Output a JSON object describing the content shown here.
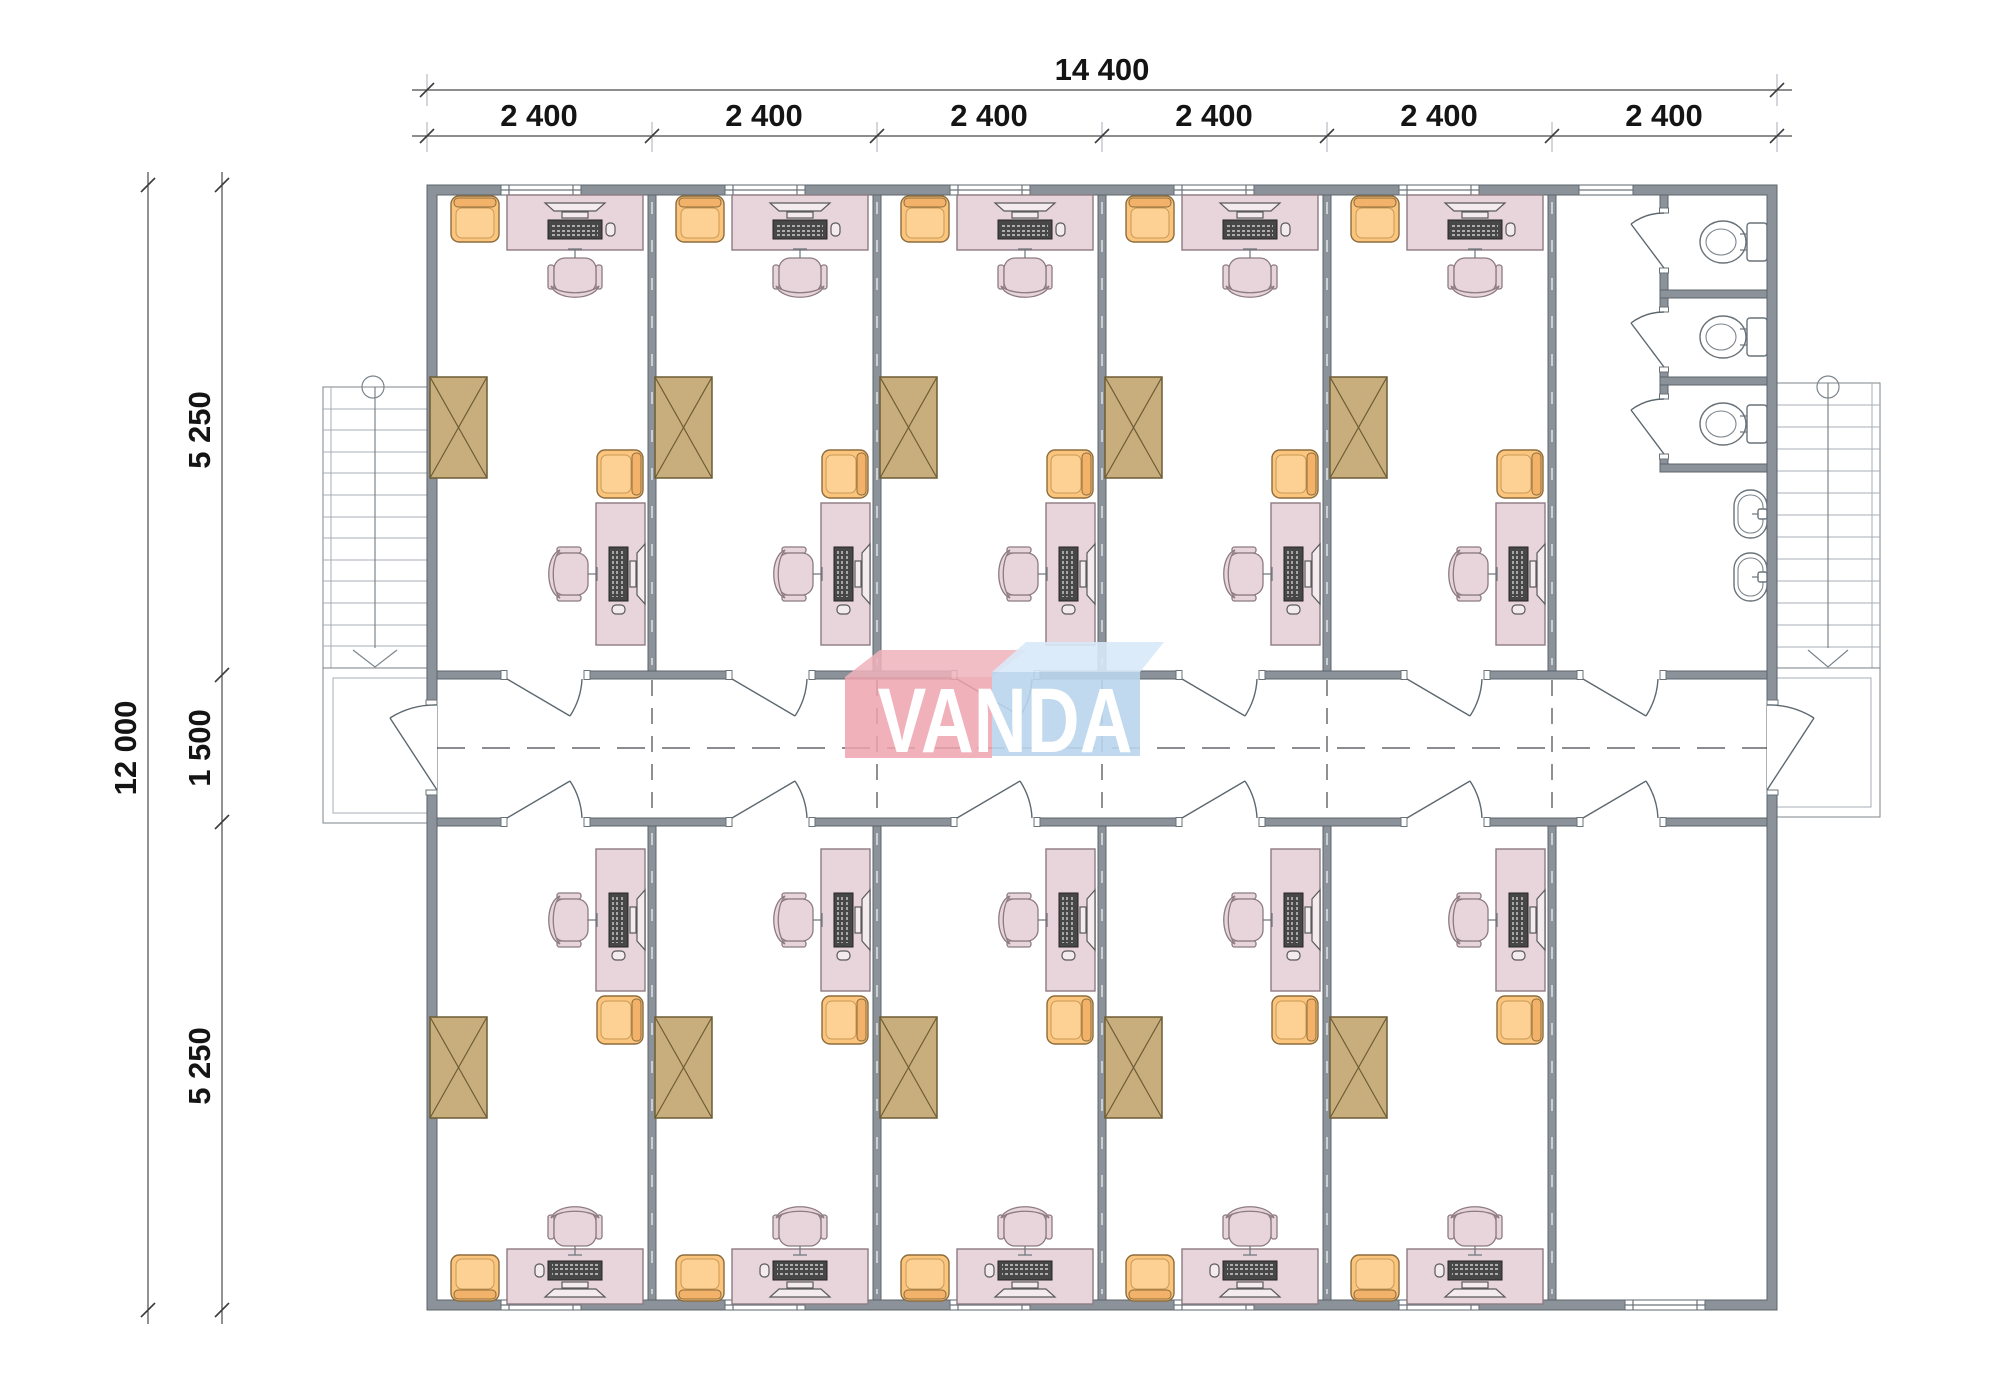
{
  "dimensions": {
    "top_total": "14 400",
    "top_segments": [
      "2 400",
      "2 400",
      "2 400",
      "2 400",
      "2 400",
      "2 400"
    ],
    "left_total": "12 000",
    "left_top": "5 250",
    "left_middle": "1 500",
    "left_bottom": "5 250"
  },
  "logo": {
    "text": "VANDA",
    "pink": "#efa3ae",
    "blue": "#b9d5ec"
  },
  "colors": {
    "wall": "#8b9299",
    "desk": "#e7d5db",
    "armchair": "#fcc57e",
    "wardrobe": "#c9ae7d",
    "fixture_line": "#6a737a"
  },
  "plan_summary": {
    "office_rooms": 10,
    "workstations_per_office": 2,
    "toilet_stalls": 3,
    "sinks": 2,
    "staircases": 2,
    "corridor_doors": 12,
    "entrances": 2
  }
}
